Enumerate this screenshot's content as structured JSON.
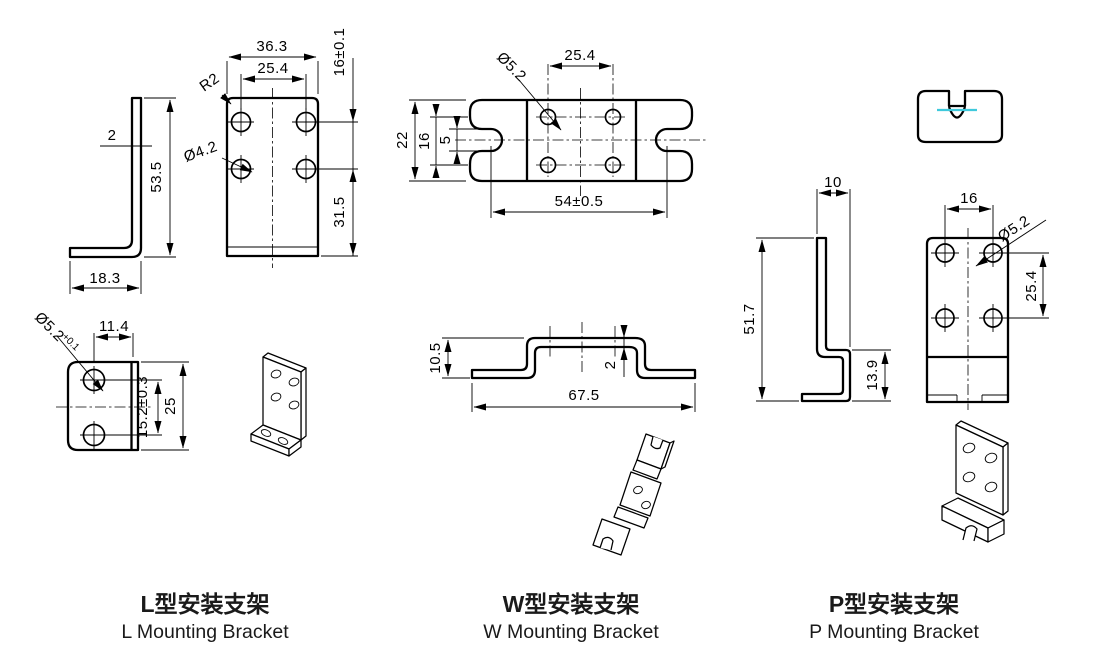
{
  "drawing": {
    "accent_color": "#3FC9DC",
    "l_bracket": {
      "label_cn": "L型安装支架",
      "label_en": "L Mounting Bracket",
      "side_view": {
        "thickness": "2",
        "height": "53.5",
        "base_width": "18.3"
      },
      "front_view": {
        "width": "36.3",
        "hole_spacing": "25.4",
        "hole_row_spacing": "16±0.1",
        "corner_radius": "R2",
        "hole_diameter": "Ø4.2",
        "lower_height": "31.5"
      },
      "bottom_view": {
        "hole_diameter": "Ø5.2",
        "hole_tolerance": "+0.1",
        "hole_offset": "11.4",
        "hole_spacing": "15.2±0.3",
        "width": "25"
      }
    },
    "w_bracket": {
      "label_cn": "W型安装支架",
      "label_en": "W Mounting Bracket",
      "top_view": {
        "hole_diameter": "Ø5.2",
        "hole_spacing": "25.4",
        "height": "22",
        "hole_row_spacing": "16",
        "slot_width": "5",
        "slot_spacing": "54±0.5"
      },
      "side_view": {
        "height": "10.5",
        "thickness": "2",
        "width": "67.5"
      }
    },
    "p_bracket": {
      "label_cn": "P型安装支架",
      "label_en": "P Mounting Bracket",
      "side_view": {
        "top_width": "10",
        "height": "51.7",
        "foot_height": "13.9"
      },
      "front_view": {
        "hole_spacing": "16",
        "hole_diameter": "Ø5.2",
        "hole_row_spacing": "25.4"
      }
    }
  }
}
